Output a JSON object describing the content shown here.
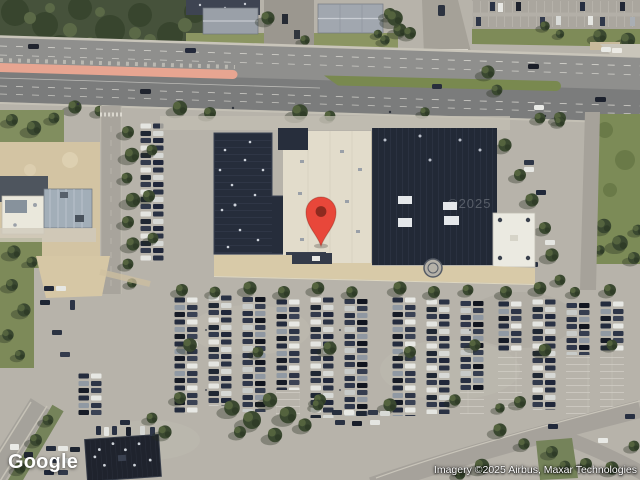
{
  "map": {
    "view_type": "satellite",
    "marker": {
      "name": "location-pin",
      "color": "#e8473a",
      "inner_color": "#8e2a1f"
    },
    "watermark_text": "©2025"
  },
  "branding": {
    "logo_text": "Google"
  },
  "attribution": {
    "text": "Imagery ©2025 Airbus, Maxar Technologies"
  },
  "colors": {
    "asphalt": "#b7b3aa",
    "highway": "#8f8f8d",
    "median_pink": "#e7a591",
    "median_grass": "#79894f",
    "forest": "#46523b",
    "grass": "#7d8a59",
    "dirt": "#d3c4a3",
    "roof_dark_navy": "#232a38",
    "roof_cream": "#e2dccb",
    "roof_white": "#ebeae1"
  }
}
